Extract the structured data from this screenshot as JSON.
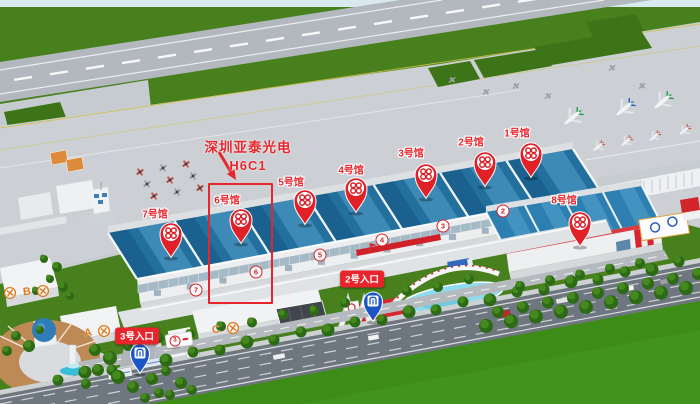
{
  "annotation": {
    "company": "深圳亚泰光电",
    "booth": "H6C1"
  },
  "halls": [
    {
      "num": "1",
      "label": "1号馆",
      "pin_x": 531,
      "pin_y": 177,
      "label_x": 517,
      "label_y": 132
    },
    {
      "num": "2",
      "label": "2号馆",
      "pin_x": 485,
      "pin_y": 186,
      "label_x": 471,
      "label_y": 141
    },
    {
      "num": "3",
      "label": "3号馆",
      "pin_x": 426,
      "pin_y": 198,
      "label_x": 411,
      "label_y": 152
    },
    {
      "num": "4",
      "label": "4号馆",
      "pin_x": 356,
      "pin_y": 212,
      "label_x": 351,
      "label_y": 169
    },
    {
      "num": "5",
      "label": "5号馆",
      "pin_x": 305,
      "pin_y": 224,
      "label_x": 291,
      "label_y": 181
    },
    {
      "num": "6",
      "label": "6号馆",
      "pin_x": 241,
      "pin_y": 243,
      "label_x": 227,
      "label_y": 199,
      "highlighted": true
    },
    {
      "num": "7",
      "label": "7号馆",
      "pin_x": 171,
      "pin_y": 257,
      "label_x": 155,
      "label_y": 213
    },
    {
      "num": "8",
      "label": "8号馆",
      "pin_x": 580,
      "pin_y": 246,
      "label_x": 564,
      "label_y": 199
    }
  ],
  "entrances": [
    {
      "label": "2号入口",
      "pin_x": 373,
      "pin_y": 321,
      "label_x": 362,
      "label_y": 279
    },
    {
      "label": "3号入口",
      "pin_x": 140,
      "pin_y": 373,
      "label_x": 137,
      "label_y": 336
    }
  ],
  "facade_numbers": [
    {
      "num": "7",
      "x": 196,
      "y": 290
    },
    {
      "num": "6",
      "x": 256,
      "y": 272
    },
    {
      "num": "5",
      "x": 320,
      "y": 255
    },
    {
      "num": "4",
      "x": 382,
      "y": 240
    },
    {
      "num": "3",
      "x": 443,
      "y": 226
    },
    {
      "num": "2",
      "x": 503,
      "y": 211
    }
  ],
  "gate_letters": [
    {
      "letter": "B",
      "x": 27,
      "y": 292
    },
    {
      "letter": "A",
      "x": 88,
      "y": 333
    },
    {
      "letter": "C",
      "x": 216,
      "y": 330
    }
  ],
  "gate_tool_icons": [
    {
      "x": 10,
      "y": 293
    },
    {
      "x": 43,
      "y": 291
    },
    {
      "x": 104,
      "y": 331
    },
    {
      "x": 233,
      "y": 328
    }
  ],
  "gate3_sign": {
    "num": "3"
  },
  "colors": {
    "marker_red": "#e02128",
    "entrance_blue": "#1c55c6",
    "roof_blue": "#236f9e",
    "highlight_red": "#e8252c"
  }
}
